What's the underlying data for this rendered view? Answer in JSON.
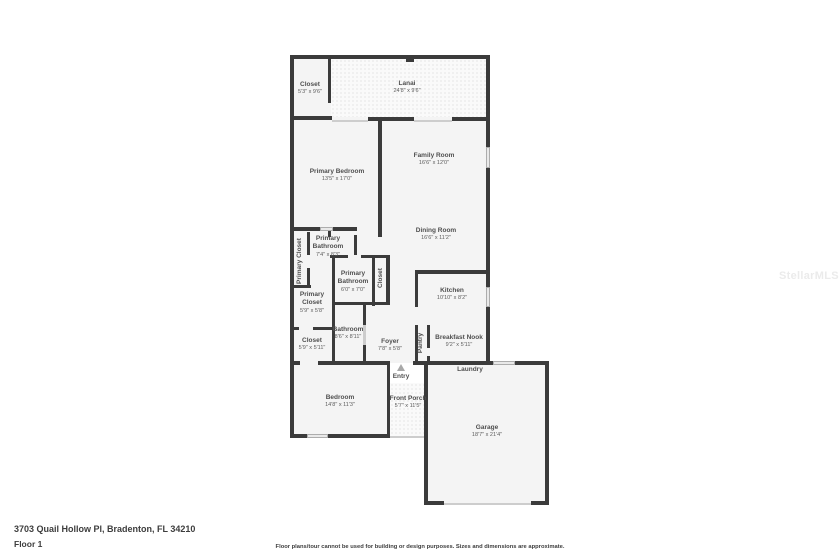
{
  "page": {
    "address": "3703 Quail Hollow Pl, Bradenton, FL 34210",
    "floor_label": "Floor 1",
    "disclaimer": "Floor plans/tour cannot be used for building or design purposes. Sizes and dimensions are approximate.",
    "watermark": "StellarMLS"
  },
  "colors": {
    "wall": "#3b3b3b",
    "room_fill": "#f4f4f4",
    "patterned_fill": "#fafafa",
    "window": "#e9e9e9",
    "label_text": "#4f4f4f",
    "footer_text": "#3d3d3d",
    "watermark_text": "#ebebeb"
  },
  "rooms": [
    {
      "name": "Closet",
      "dims": "5'3\" x 9'6\""
    },
    {
      "name": "Lanai",
      "dims": "24'8\" x 9'6\""
    },
    {
      "name": "Primary Bedroom",
      "dims": "13'5\" x 17'0\""
    },
    {
      "name": "Family Room",
      "dims": "16'6\" x 12'0\""
    },
    {
      "name": "Dining Room",
      "dims": "16'6\" x 11'2\""
    },
    {
      "name": "Primary Closet",
      "dims": ""
    },
    {
      "name": "Primary Bathroom",
      "dims": "7'4\" x 8'3\""
    },
    {
      "name": "Primary Bathroom",
      "dims": "6'0\" x 7'0\""
    },
    {
      "name": "Closet",
      "dims": ""
    },
    {
      "name": "Primary Closet",
      "dims": "5'9\" x 5'8\""
    },
    {
      "name": "Bathroom",
      "dims": "8'6\" x 8'11\""
    },
    {
      "name": "Closet",
      "dims": "5'9\" x 5'11\""
    },
    {
      "name": "Foyer",
      "dims": "7'8\" x 5'8\""
    },
    {
      "name": "Kitchen",
      "dims": "10'10\" x 8'2\""
    },
    {
      "name": "Pantry",
      "dims": ""
    },
    {
      "name": "Breakfast Nook",
      "dims": "9'2\" x 5'11\""
    },
    {
      "name": "Laundry",
      "dims": ""
    },
    {
      "name": "Entry",
      "dims": ""
    },
    {
      "name": "Front Porch",
      "dims": "5'7\" x 11'5\""
    },
    {
      "name": "Bedroom",
      "dims": "14'8\" x 11'3\""
    },
    {
      "name": "Garage",
      "dims": "18'7\" x 21'4\""
    }
  ]
}
